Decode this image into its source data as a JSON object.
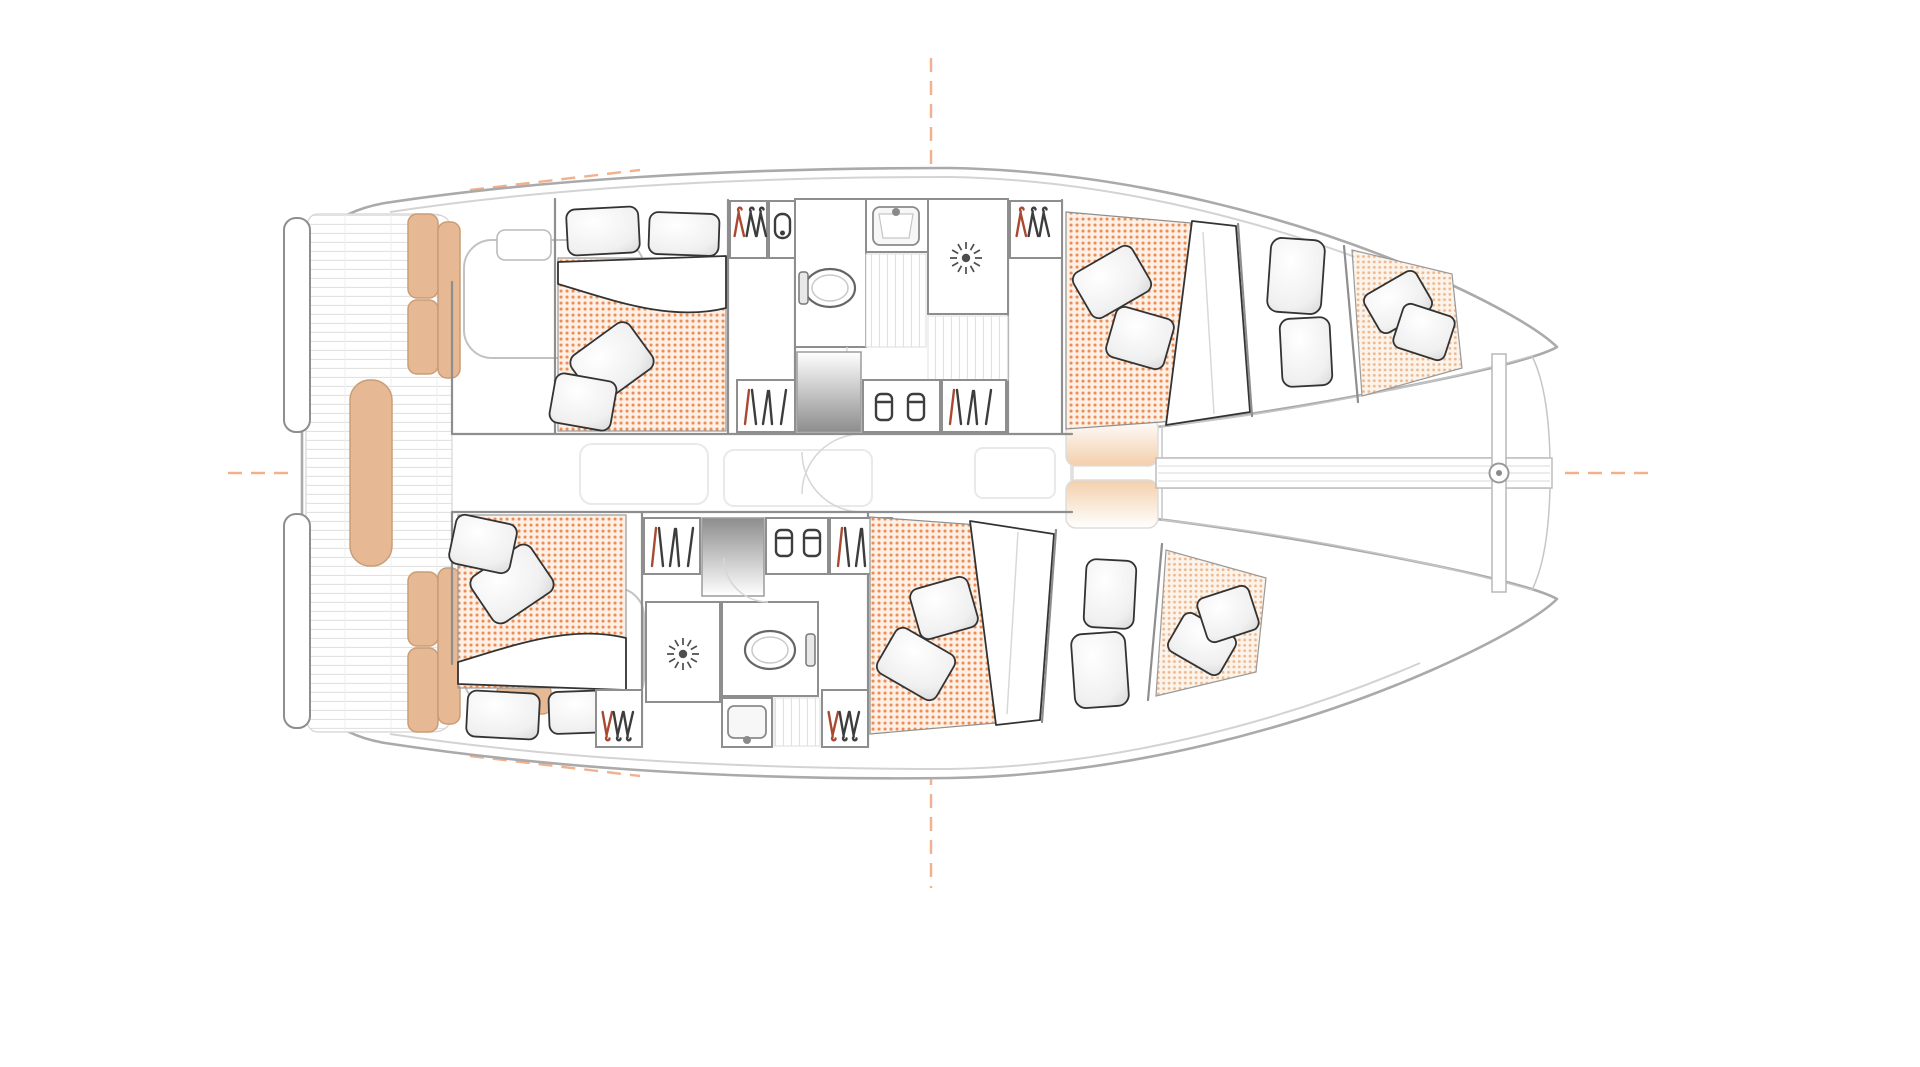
{
  "page": {
    "background": "#ffffff"
  },
  "palette": {
    "hull": "#abaaaa",
    "edge": "#d3d3d3",
    "wall": "#8e8e8e",
    "ink": "#333333",
    "red": "#a84a32",
    "tan": "#e6b893",
    "tan_line": "#c99d76",
    "mat_dot": "#eb8246",
    "mat_bg": "#fdf0e6",
    "fine_dot": "#edb88e",
    "fine_bg": "#fcf3ea",
    "tramp_dot": "#ecd0ba",
    "plank": "#e2e2e2",
    "guide": "#ef9e70",
    "pad": "#f3cfab"
  },
  "diagram": {
    "type": "floor-plan",
    "subject": "sailing catamaran accommodation and deck plan",
    "orientation": "top-down, bow to the right, stern to the left",
    "aria_label": "Catamaran four-cabin accommodation floor plan, top view, bow pointing right",
    "counts": {
      "double_cabins": 4,
      "bathrooms": 2,
      "toilets": 2,
      "wash_basins": 2,
      "showers": 2,
      "wardrobe_hanger_shelves": 4,
      "bookshelves": 4,
      "glassware_cabinets": 2,
      "companionway_steps": 2,
      "bow_berths": 2,
      "forepeak_berths": 2,
      "trampoline_panels": 2,
      "foredeck_lockers": 2,
      "cockpit_cushion_sets": 2
    },
    "areas": [
      {
        "name": "aft-deck",
        "zone": "stern",
        "features": [
          "twin transom swim platforms",
          "plank cockpit sole",
          "L-shaped bench cushions port and starboard",
          "central sun lounge",
          "two cockpit settees",
          "small side tables"
        ]
      },
      {
        "name": "saloon",
        "zone": "bridgedeck midship",
        "features": [
          "very faint furniture outlines",
          "sliding-door swing arcs"
        ]
      },
      {
        "name": "upper-hull-aft-cabin",
        "zone": "upper hull aft",
        "features": [
          "double berth",
          "two head pillows",
          "orange dotted mattress",
          "folded white duvet",
          "two throw pillows"
        ]
      },
      {
        "name": "upper-hull-wardrobe",
        "zone": "upper hull",
        "features": [
          "hanger shelf with one red and two dark hangers",
          "small cabinet with latch icon"
        ]
      },
      {
        "name": "upper-hull-head",
        "zone": "upper hull amidships",
        "features": [
          "toilet with cistern",
          "wash basin with faucet",
          "shower cubicle with sunburst drain",
          "plank corridor",
          "door swing arc"
        ]
      },
      {
        "name": "upper-hull-storage-row",
        "zone": "upper hull inboard",
        "features": [
          "bookshelf",
          "gradient companionway steps",
          "cabinet with two glasses",
          "bookshelf"
        ]
      },
      {
        "name": "upper-hull-forward-cabin",
        "zone": "upper hull forward",
        "features": [
          "double berth",
          "orange dotted mattress",
          "two throw pillows",
          "folded duvet wedge"
        ]
      },
      {
        "name": "upper-hull-bow-berth",
        "zone": "upper hull bow",
        "features": [
          "two upright pillows"
        ]
      },
      {
        "name": "upper-hull-forepeak",
        "zone": "upper hull bow tip",
        "features": [
          "fine dotted berth pad",
          "two throw pillows"
        ]
      },
      {
        "name": "lower-hull-aft-cabin",
        "zone": "lower hull aft",
        "features": [
          "double berth",
          "two head pillows",
          "orange dotted mattress",
          "folded white duvet",
          "two throw pillows"
        ]
      },
      {
        "name": "lower-hull-storage-row",
        "zone": "lower hull inboard",
        "features": [
          "bookshelf",
          "gradient companionway steps",
          "cabinet with two glasses",
          "bookshelf"
        ]
      },
      {
        "name": "lower-hull-head",
        "zone": "lower hull amidships",
        "features": [
          "shower cubicle with sunburst drain",
          "toilet with cistern",
          "wash basin with faucet",
          "two hanger shelves",
          "plank corridor"
        ]
      },
      {
        "name": "lower-hull-forward-cabin",
        "zone": "lower hull forward",
        "features": [
          "double berth",
          "orange dotted mattress",
          "two throw pillows",
          "folded duvet wedge"
        ]
      },
      {
        "name": "lower-hull-bow-berth",
        "zone": "lower hull bow",
        "features": [
          "two upright pillows"
        ]
      },
      {
        "name": "lower-hull-forepeak",
        "zone": "lower hull bow tip",
        "features": [
          "fine dotted berth pad",
          "two throw pillows"
        ]
      },
      {
        "name": "foredeck",
        "zone": "between hulls forward",
        "features": [
          "two peach gradient locker pads"
        ]
      },
      {
        "name": "trampoline",
        "zone": "bow",
        "features": [
          "upper polka-dot netting panel",
          "lower polka-dot netting panel",
          "longitudinal bowsprit beam",
          "vertical bow crossbeam",
          "forestay ring fitting"
        ]
      },
      {
        "name": "rig-guides",
        "zone": "around hull",
        "features": [
          "orange dashed centreline marks top and bottom",
          "orange dashed marks at stern and bow",
          "orange dashed shoulder marks along hull curve"
        ]
      }
    ]
  }
}
